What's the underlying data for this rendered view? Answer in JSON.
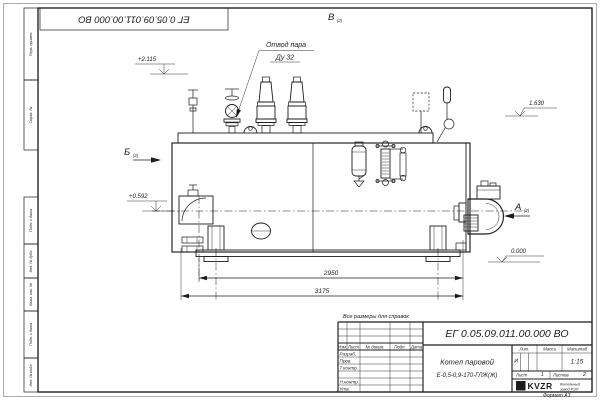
{
  "drawing": {
    "doc_number": "ЕГ 0.05.09.011.00.000  ВО",
    "corner_number": "ЕГ 0.05.09.011.00.000  ВО",
    "note": "Все размеры для справок",
    "format": "Формат А3"
  },
  "margin": {
    "boxes": [
      "Перв. примен.",
      "Справ. №",
      "Подп. и дата",
      "Инв. № дубл.",
      "Взам. инв. №",
      "Подп. и дата",
      "Инв. № подл."
    ]
  },
  "annotations": {
    "steam_outlet": {
      "line1": "Отвод пара",
      "line2": "Ду 32"
    },
    "views": {
      "a": "А",
      "b": "Б",
      "v": "В",
      "ref": "(2)"
    },
    "elevations": {
      "top": "+2.115",
      "axis": "+0.592",
      "right": "1.630",
      "zero": "0.000"
    },
    "dimensions": {
      "inner": "2950",
      "overall": "3175"
    }
  },
  "title_block": {
    "product_line1": "Котел паровой",
    "product_line2": "Е-0,5-0,9-170-ГЛЖ(Ж)",
    "cols": {
      "izm": "Изм.",
      "list": "Лист",
      "doc": "№ докум.",
      "sign": "Подп.",
      "date": "Дата"
    },
    "rows": {
      "r1": "Разраб.",
      "r2": "Пров.",
      "r3": "Т.контр.",
      "r4": "Н.контр.",
      "r5": "Утв."
    },
    "props": {
      "lit": "Лит.",
      "mass": "Масса",
      "scale": "Масштаб",
      "lit_value": "И",
      "scale_value": "1:15"
    },
    "sheets": {
      "sheet_label": "Лист",
      "sheet_value": "1",
      "sheets_label": "Листов",
      "sheets_value": "2"
    },
    "company": {
      "logo": "KVZR",
      "logo_letter": "К",
      "line1": "Котельный",
      "line2": "завод РЭП"
    }
  }
}
